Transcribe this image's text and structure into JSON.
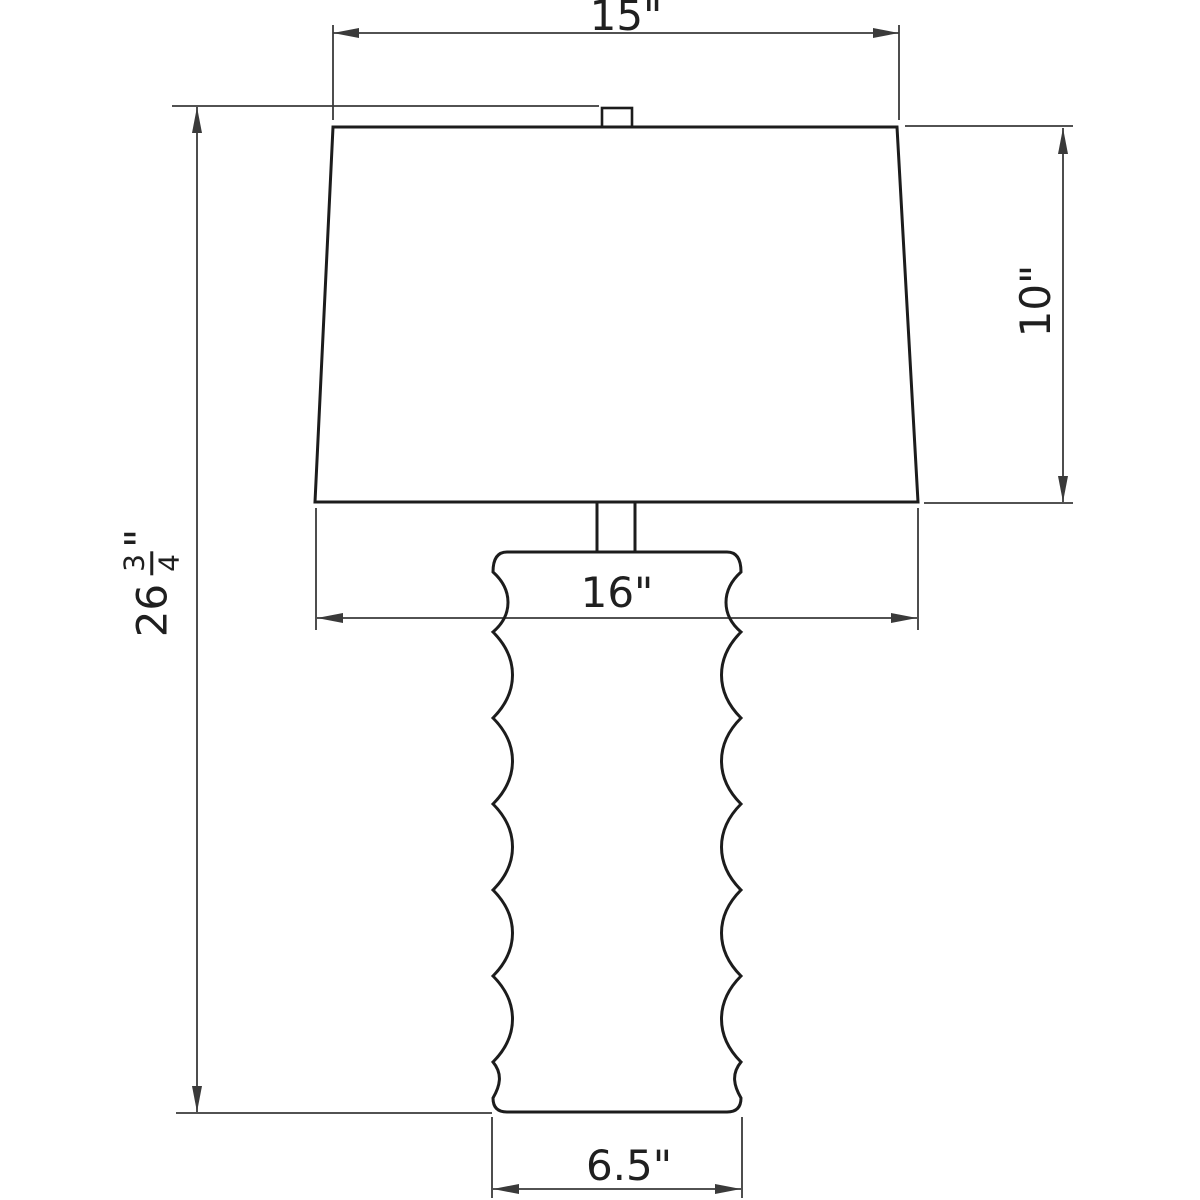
{
  "colors": {
    "lamp_line": "#1c1c1c",
    "dimension_line": "#3a3a3a",
    "background": "#ffffff"
  },
  "dimensions": {
    "shade_top_width": "15\"",
    "shade_height": "10\"",
    "shade_bottom_width": "16\"",
    "base_width": "6.5\"",
    "total_height": {
      "whole": "26",
      "numerator": "3",
      "denominator": "4",
      "unit": "\""
    }
  }
}
